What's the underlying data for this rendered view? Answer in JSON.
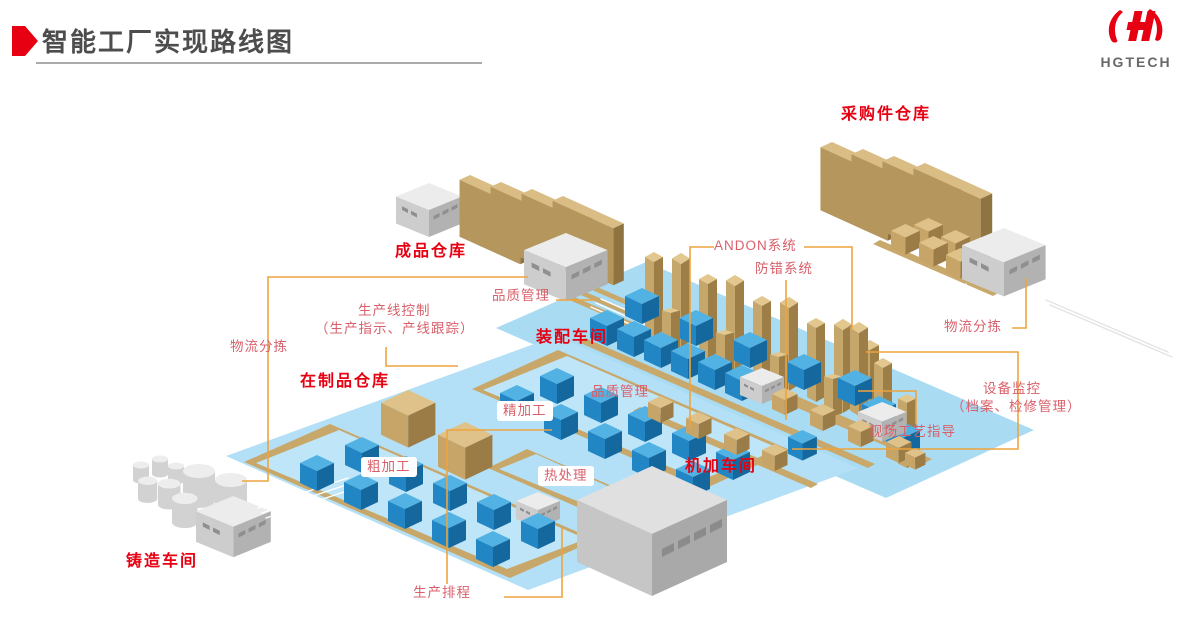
{
  "header": {
    "title": "智能工厂实现路线图"
  },
  "logo": {
    "text": "HGTECH"
  },
  "diagram": {
    "labels": {
      "purchased_warehouse": "采购件仓库",
      "finished_warehouse": "成品仓库",
      "quality_top": "品质管理",
      "line_control_line1": "生产线控制",
      "line_control_line2": "（生产指示、产线跟踪）",
      "logistics_left": "物流分拣",
      "wip_warehouse": "在制品仓库",
      "assembly_shop": "装配车间",
      "andon": "ANDON系统",
      "error_proofing": "防错系统",
      "quality_mid": "品质管理",
      "fine_machining": "精加工",
      "rough_machining": "粗加工",
      "heat_treatment": "热处理",
      "machining_shop": "机加车间",
      "logistics_right": "物流分拣",
      "equipment_monitoring_line1": "设备监控",
      "equipment_monitoring_line2": "（档案、检修管理）",
      "site_process_guidance": "现场工艺指导",
      "casting_shop": "铸造车间",
      "production_scheduling": "生产排程"
    },
    "colors": {
      "accent_red": "#e60012",
      "label_rose": "#d9606b",
      "connector_orange": "#eea43e",
      "floor_blue": "#a9dbf3",
      "cube_blue": "#2286c5",
      "structure_tan": "#c8a76a",
      "machine_gray": "#cdcdcd"
    }
  }
}
